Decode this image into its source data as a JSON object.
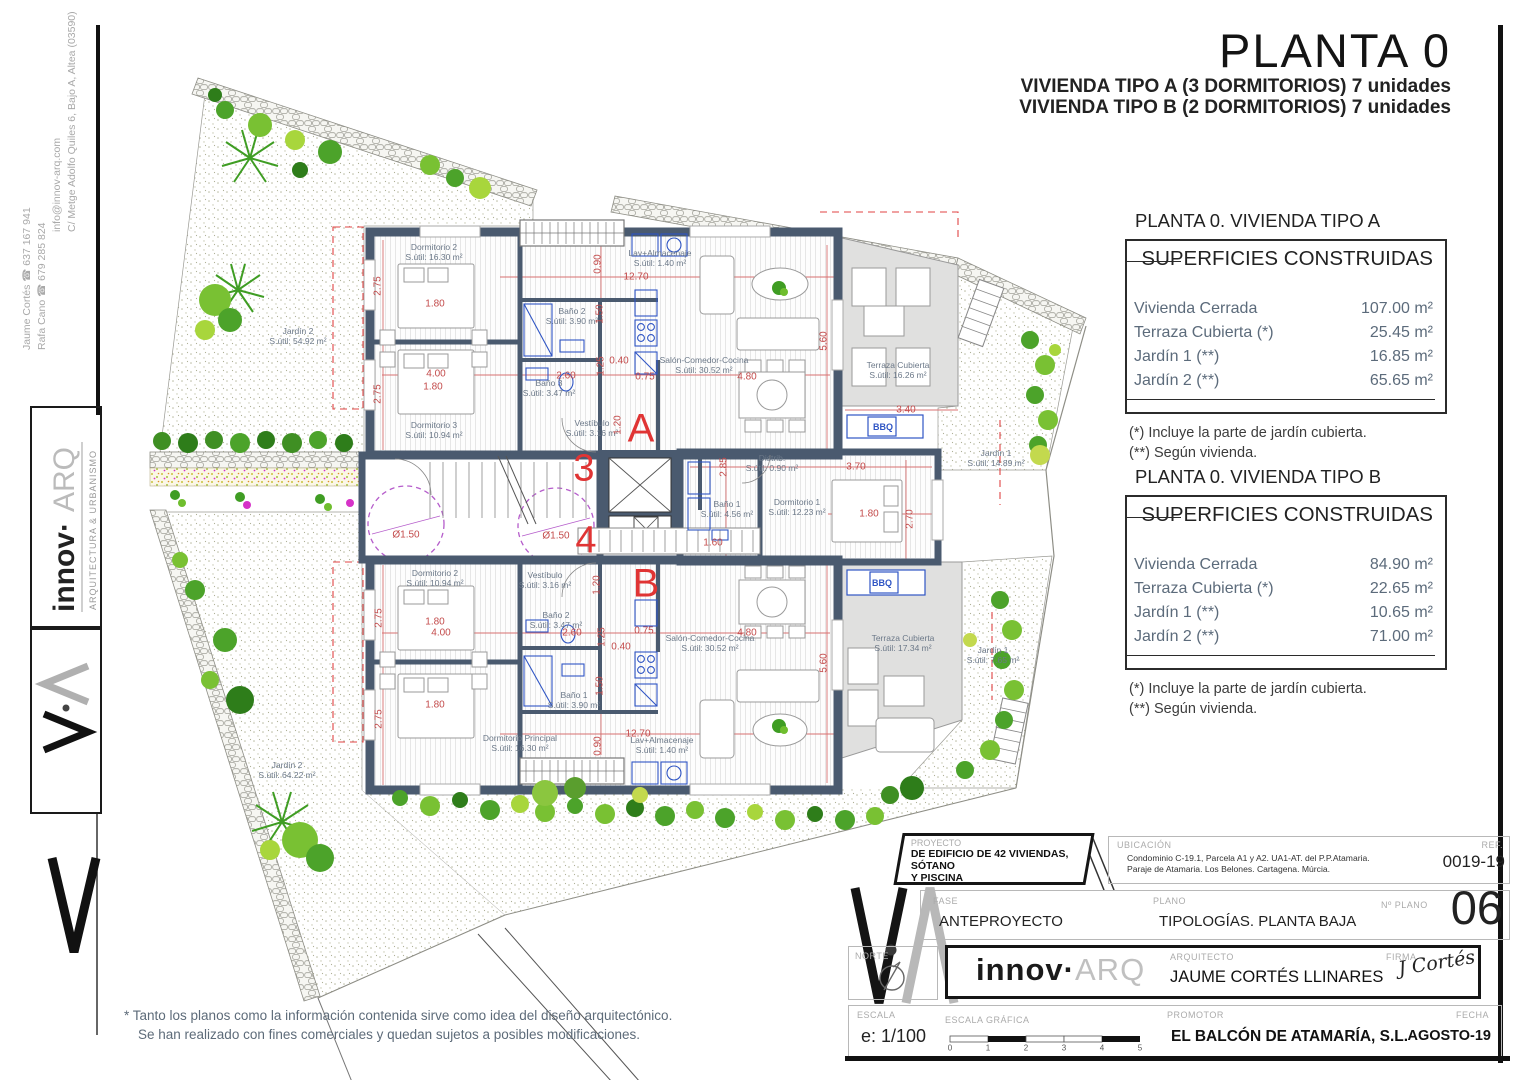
{
  "sheet": {
    "title": "PLANTA 0",
    "subtitle1": "VIVIENDA TIPO A (3 DORMITORIOS) 7 unidades",
    "subtitle2": "VIVIENDA TIPO B (2 DORMITORIOS) 7 unidades",
    "disclaimer1": "* Tanto los planos como la información contenida sirve como idea del diseño arquitectónico.",
    "disclaimer2": "Se han realizado con fines comerciales y quedan sujetos a posibles modificaciones."
  },
  "contact": {
    "address": "C/ Metge Adolfo Quiles 6, Bajo A, Altea (03590)",
    "email": "info@innov-arq.com",
    "phone1": "Rafa Cano ☎ 679 285 824",
    "phone2": "Jaume Cortés ☎ 637 167 941"
  },
  "logo": {
    "part1": "innov·",
    "part2": "ARQ",
    "tagline": "ARQUITECTURA & URBANISMO"
  },
  "panel_a": {
    "heading": "PLANTA 0. VIVIENDA TIPO A",
    "table_title": "SUPERFICIES CONSTRUIDAS",
    "rows": [
      {
        "label": "Vivienda Cerrada",
        "value": "107.00 m²"
      },
      {
        "label": "Terraza Cubierta  (*)",
        "value": "25.45 m²"
      },
      {
        "label": "Jardín 1 (**)",
        "value": "16.85 m²"
      },
      {
        "label": "Jardín 2 (**)",
        "value": "65.65 m²"
      }
    ],
    "note1": "(*)  Incluye la parte de jardín cubierta.",
    "note2": "(**) Según vivienda."
  },
  "panel_b": {
    "heading": "PLANTA 0. VIVIENDA TIPO B",
    "table_title": "SUPERFICIES CONSTRUIDAS",
    "rows": [
      {
        "label": "Vivienda Cerrada",
        "value": "84.90 m²"
      },
      {
        "label": "Terraza Cubierta (*)",
        "value": "22.65 m²"
      },
      {
        "label": "Jardín 1 (**)",
        "value": "10.65 m²"
      },
      {
        "label": "Jardín 2 (**)",
        "value": "71.00 m²"
      }
    ],
    "note1": "(*) Incluye la parte de jardín cubierta.",
    "note2": "(**) Según vivienda."
  },
  "titleblock": {
    "proyecto_label": "PROYECTO",
    "proyecto_line1": "DE EDIFICIO DE 42 VIVIENDAS, SÓTANO",
    "proyecto_line2": "Y PISCINA",
    "ubicacion_label": "UBICACIÓN",
    "ubicacion_line1": "Condominio C-19.1, Parcela A1 y A2. UA1-AT. del P.P.Atamaria.",
    "ubicacion_line2": "Paraje de Atamaria. Los Belones. Cartagena. Múrcia.",
    "ref_label": "REF.",
    "ref_value": "0019-19",
    "fase_label": "FASE",
    "fase_value": "ANTEPROYECTO",
    "plano_label": "PLANO",
    "plano_value": "TIPOLOGÍAS. PLANTA BAJA",
    "num_label": "Nº PLANO",
    "num_value": "06",
    "norte_label": "NORTE",
    "arquitecto_label": "ARQUITECTO",
    "arquitecto_value": "JAUME CORTÉS LLINARES",
    "firma_label": "FIRMA",
    "firma_value": "J Cortés",
    "escala_label": "ESCALA",
    "escala_value": "e: 1/100",
    "escala_grafica_label": "ESCALA GRÁFICA",
    "scale_ticks": [
      "0",
      "1",
      "2",
      "3",
      "4",
      "5"
    ],
    "promotor_label": "PROMOTOR",
    "promotor_value": "EL BALCÓN DE ATAMARÍA, S.L.",
    "fecha_label": "FECHA",
    "fecha_value": "AGOSTO-19"
  },
  "plan": {
    "rooms": [
      {
        "name": "Dormitorio 2",
        "area": "S.útil: 16.30 m²",
        "x": 434,
        "y": 252
      },
      {
        "name": "Dormitorio 3",
        "area": "S.útil: 10.94 m²",
        "x": 434,
        "y": 430
      },
      {
        "name": "Baño 2",
        "area": "S.útil: 3.90 m²",
        "x": 572,
        "y": 316
      },
      {
        "name": "Baño 3",
        "area": "S.útil: 3.47 m²",
        "x": 549,
        "y": 388
      },
      {
        "name": "Lav+Almacenaje",
        "area": "S.útil: 1.40 m²",
        "x": 660,
        "y": 258
      },
      {
        "name": "Salón-Comedor-Cocina",
        "area": "S.útil: 30.52 m²",
        "x": 704,
        "y": 365
      },
      {
        "name": "Terraza Cubierta",
        "area": "S.útil: 16.26 m²",
        "x": 898,
        "y": 370
      },
      {
        "name": "Vestíbulo",
        "area": "S.útil: 3.16 m²",
        "x": 592,
        "y": 428
      },
      {
        "name": "Distrib.",
        "area": "S.útil: 0.90 m²",
        "x": 772,
        "y": 463
      },
      {
        "name": "Baño 1",
        "area": "S.útil: 4.56 m²",
        "x": 727,
        "y": 509
      },
      {
        "name": "Dormitorio 1",
        "area": "S.útil: 12.23 m²",
        "x": 797,
        "y": 507
      },
      {
        "name": "Dormitorio 2",
        "area": "S.útil: 10.94 m²",
        "x": 435,
        "y": 578
      },
      {
        "name": "Vestíbulo",
        "area": "S.útil: 3.16 m²",
        "x": 545,
        "y": 580
      },
      {
        "name": "Baño 2",
        "area": "S.útil: 3.47 m²",
        "x": 556,
        "y": 620
      },
      {
        "name": "Baño 1",
        "area": "S.útil: 3.90 m²",
        "x": 574,
        "y": 700
      },
      {
        "name": "Dormitorio Principal",
        "area": "S.útil: 16.30 m²",
        "x": 520,
        "y": 743
      },
      {
        "name": "Lav+Almacenaje",
        "area": "S.útil: 1.40 m²",
        "x": 662,
        "y": 745
      },
      {
        "name": "Salón-Comedor-Cocina",
        "area": "S.útil: 30.52 m²",
        "x": 710,
        "y": 643
      },
      {
        "name": "Terraza Cubierta",
        "area": "S.útil: 17.34 m²",
        "x": 903,
        "y": 643
      }
    ],
    "gardens": [
      {
        "name": "Jardín 2",
        "area": "S.útil: 54.92 m²",
        "x": 298,
        "y": 336
      },
      {
        "name": "Jardín 1",
        "area": "S.útil: 14.89 m²",
        "x": 996,
        "y": 458
      },
      {
        "name": "Jardín 1",
        "area": "S.útil: 7.65 m²",
        "x": 993,
        "y": 655
      },
      {
        "name": "Jardín 2",
        "area": "S.útil: 64.22 m²",
        "x": 287,
        "y": 770
      }
    ],
    "dims": [
      {
        "t": "2.75",
        "x": 378,
        "y": 286,
        "r": 1
      },
      {
        "t": "1.80",
        "x": 435,
        "y": 304,
        "r": 0
      },
      {
        "t": "4.00",
        "x": 436,
        "y": 374,
        "r": 0
      },
      {
        "t": "1.80",
        "x": 433,
        "y": 387,
        "r": 0
      },
      {
        "t": "2.75",
        "x": 378,
        "y": 394,
        "r": 1
      },
      {
        "t": "12.70",
        "x": 636,
        "y": 277,
        "r": 0
      },
      {
        "t": "0.90",
        "x": 598,
        "y": 264,
        "r": 1
      },
      {
        "t": "1.50",
        "x": 600,
        "y": 314,
        "r": 1
      },
      {
        "t": "2.60",
        "x": 566,
        "y": 376,
        "r": 0
      },
      {
        "t": "1.25",
        "x": 601,
        "y": 366,
        "r": 1
      },
      {
        "t": "0.40",
        "x": 619,
        "y": 361,
        "r": 0
      },
      {
        "t": "0.75",
        "x": 645,
        "y": 377,
        "r": 0
      },
      {
        "t": "1.20",
        "x": 618,
        "y": 425,
        "r": 1
      },
      {
        "t": "5.60",
        "x": 824,
        "y": 341,
        "r": 1
      },
      {
        "t": "4.80",
        "x": 747,
        "y": 377,
        "r": 0
      },
      {
        "t": "3.40",
        "x": 906,
        "y": 410,
        "r": 0
      },
      {
        "t": "2.85",
        "x": 724,
        "y": 467,
        "r": 1
      },
      {
        "t": "3.70",
        "x": 856,
        "y": 467,
        "r": 0
      },
      {
        "t": "1.80",
        "x": 869,
        "y": 514,
        "r": 0
      },
      {
        "t": "2.70",
        "x": 910,
        "y": 519,
        "r": 1
      },
      {
        "t": "1.60",
        "x": 713,
        "y": 543,
        "r": 0
      },
      {
        "t": "1.20",
        "x": 597,
        "y": 585,
        "r": 1
      },
      {
        "t": "2.75",
        "x": 379,
        "y": 618,
        "r": 1
      },
      {
        "t": "1.80",
        "x": 435,
        "y": 622,
        "r": 0
      },
      {
        "t": "4.00",
        "x": 441,
        "y": 633,
        "r": 0
      },
      {
        "t": "2.60",
        "x": 572,
        "y": 633,
        "r": 0
      },
      {
        "t": "1.25",
        "x": 602,
        "y": 637,
        "r": 1
      },
      {
        "t": "0.40",
        "x": 621,
        "y": 647,
        "r": 0
      },
      {
        "t": "0.75",
        "x": 644,
        "y": 631,
        "r": 0
      },
      {
        "t": "1.50",
        "x": 600,
        "y": 686,
        "r": 1
      },
      {
        "t": "2.75",
        "x": 379,
        "y": 719,
        "r": 1
      },
      {
        "t": "1.80",
        "x": 435,
        "y": 705,
        "r": 0
      },
      {
        "t": "12.70",
        "x": 638,
        "y": 734,
        "r": 0
      },
      {
        "t": "0.90",
        "x": 598,
        "y": 746,
        "r": 1
      },
      {
        "t": "4.80",
        "x": 747,
        "y": 633,
        "r": 0
      },
      {
        "t": "5.60",
        "x": 824,
        "y": 663,
        "r": 1
      },
      {
        "t": "Ø1.50",
        "x": 406,
        "y": 535,
        "r": 0
      },
      {
        "t": "Ø1.50",
        "x": 556,
        "y": 536,
        "r": 0
      }
    ],
    "marks": [
      {
        "t": "A",
        "x": 641,
        "y": 429,
        "s": 40
      },
      {
        "t": "3",
        "x": 584,
        "y": 469,
        "s": 38
      },
      {
        "t": "4",
        "x": 586,
        "y": 541,
        "s": 38
      },
      {
        "t": "B",
        "x": 646,
        "y": 584,
        "s": 40
      }
    ],
    "bbq": [
      {
        "t": "BBQ",
        "x": 883,
        "y": 427
      },
      {
        "t": "BBQ",
        "x": 882,
        "y": 583
      }
    ]
  }
}
